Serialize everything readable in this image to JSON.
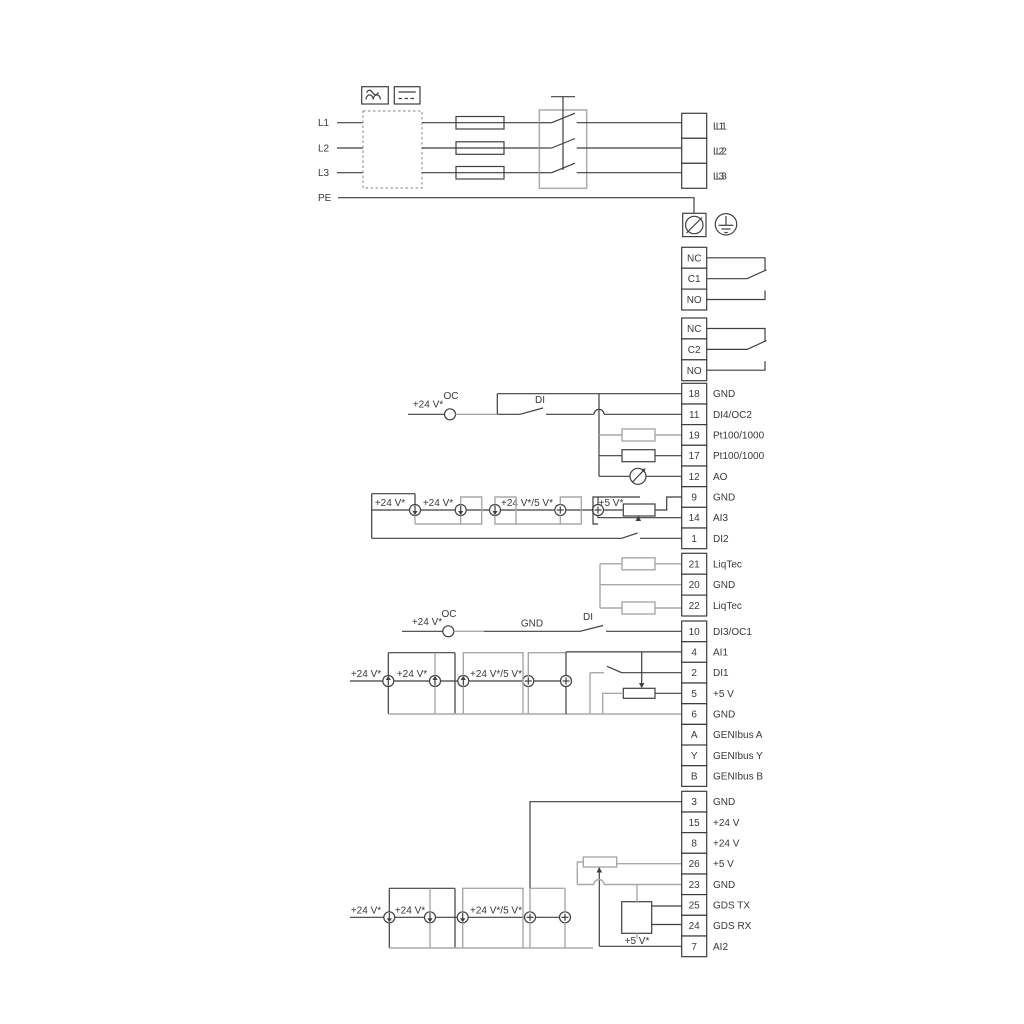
{
  "power": {
    "inputs": [
      "L1",
      "L2",
      "L3",
      "PE"
    ],
    "outputs": [
      "L1",
      "L2",
      "L3"
    ]
  },
  "relays": [
    {
      "terminals": [
        {
          "n": "NC",
          "l": ""
        },
        {
          "n": "C1",
          "l": ""
        },
        {
          "n": "NO",
          "l": ""
        }
      ]
    },
    {
      "terminals": [
        {
          "n": "NC",
          "l": ""
        },
        {
          "n": "C2",
          "l": ""
        },
        {
          "n": "NO",
          "l": ""
        }
      ]
    }
  ],
  "strips": {
    "power_out": [
      {
        "n": "",
        "l": "L1"
      },
      {
        "n": "",
        "l": "L2"
      },
      {
        "n": "",
        "l": "L3"
      }
    ],
    "io1": [
      {
        "n": "18",
        "l": "GND"
      },
      {
        "n": "11",
        "l": "DI4/OC2"
      },
      {
        "n": "19",
        "l": "Pt100/1000"
      },
      {
        "n": "17",
        "l": "Pt100/1000"
      },
      {
        "n": "12",
        "l": "AO"
      },
      {
        "n": "9",
        "l": "GND"
      },
      {
        "n": "14",
        "l": "AI3"
      },
      {
        "n": "1",
        "l": "DI2"
      }
    ],
    "liqtec": [
      {
        "n": "21",
        "l": "LiqTec"
      },
      {
        "n": "20",
        "l": "GND"
      },
      {
        "n": "22",
        "l": "LiqTec"
      }
    ],
    "io2": [
      {
        "n": "10",
        "l": "DI3/OC1"
      },
      {
        "n": "4",
        "l": "AI1"
      },
      {
        "n": "2",
        "l": "DI1"
      },
      {
        "n": "5",
        "l": "+5 V"
      },
      {
        "n": "6",
        "l": "GND"
      },
      {
        "n": "A",
        "l": "GENIbus A"
      },
      {
        "n": "Y",
        "l": "GENIbus Y"
      },
      {
        "n": "B",
        "l": "GENIbus B"
      }
    ],
    "io3": [
      {
        "n": "3",
        "l": "GND"
      },
      {
        "n": "15",
        "l": "+24 V"
      },
      {
        "n": "8",
        "l": "+24 V"
      },
      {
        "n": "26",
        "l": "+5 V"
      },
      {
        "n": "23",
        "l": "GND"
      },
      {
        "n": "25",
        "l": "GDS TX"
      },
      {
        "n": "24",
        "l": "GDS RX"
      },
      {
        "n": "7",
        "l": "AI2"
      }
    ]
  },
  "annotations": {
    "oc_top": "OC",
    "di_top": "DI",
    "v24_top": "+24 V*",
    "g1_a": "+24 V*",
    "g1_b": "+24 V*",
    "g1_c": "+24 V*/5 V*",
    "g1_d": "+5 V*",
    "oc_mid": "OC",
    "di_mid": "DI",
    "v24_mid": "+24 V*",
    "gnd_mid": "GND",
    "g2_a": "+24 V*",
    "g2_b": "+24 V*",
    "g2_c": "+24 V*/5 V*",
    "g3_a": "+24 V*",
    "g3_b": "+24 V*",
    "g3_c": "+24 V*/5 V*",
    "g3_d": "+5 V*"
  },
  "colors": {
    "line": "#3f3f3f",
    "gray": "#a8a8a8",
    "background": "#ffffff"
  }
}
